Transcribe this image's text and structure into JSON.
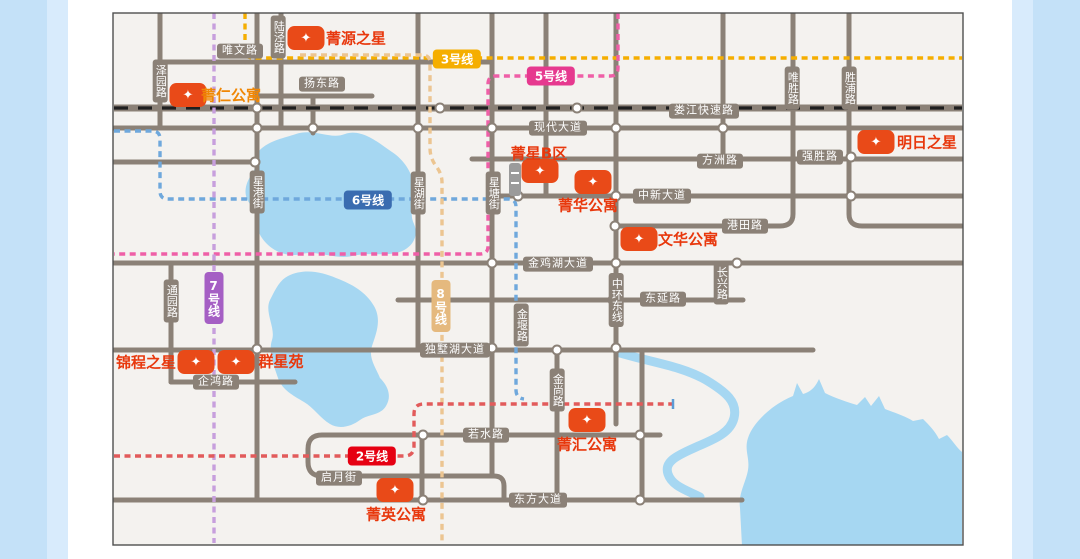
{
  "frame": {
    "outer_bg": "#ffffff",
    "left_band": {
      "x": 0,
      "w": 47,
      "color": "#c4e1f8"
    },
    "left_band_inner": {
      "x": 47,
      "w": 21,
      "color": "#d8ebfc"
    },
    "right_band_inner": {
      "x": 1012,
      "w": 21,
      "color": "#d8ebfc"
    },
    "right_band": {
      "x": 1033,
      "w": 47,
      "color": "#c4e1f8"
    }
  },
  "map": {
    "x": 113,
    "y": 13,
    "w": 850,
    "h": 532,
    "bg": "#f4f2ef",
    "border_color": "#4f4f4f"
  },
  "palette": {
    "road": "#8b8177",
    "road_badge_bg": "#8b8177",
    "badge_text": "#ffffff",
    "water": "#a6d7f2",
    "railway_dash": "#1f1f1f",
    "node_fill": "#ffffff",
    "marker_bg": "#e94a18",
    "marker_star": "#ffffff",
    "building_gray": "#9b9b9b"
  },
  "roads": [
    {
      "name": "weiwen-road",
      "d": "M160 62H492"
    },
    {
      "name": "yangdong-road",
      "d": "M258 96H372"
    },
    {
      "name": "xiandai-road",
      "d": "M114 128H962"
    },
    {
      "name": "fangzhou-qiangsheng-road",
      "d": "M472 159H962"
    },
    {
      "name": "zhongxin-road",
      "d": "M492 196H962"
    },
    {
      "name": "weisheng-gangtian-west-road",
      "d": "M793 13V214Q793 226 780 226H615"
    },
    {
      "name": "shengpu-gangtian-east-road",
      "d": "M849 13V214Q849 226 862 226H962"
    },
    {
      "name": "jinjihu-road",
      "d": "M114 263H962"
    },
    {
      "name": "dongyan-changxing-road",
      "d": "M398 300H743"
    },
    {
      "name": "dushuhu-road",
      "d": "M114 350H813"
    },
    {
      "name": "qihong-road",
      "d": "M171 382H295"
    },
    {
      "name": "ruoshui-qiyue-road",
      "d": "M660 435H322Q308 435 308 449V462Q308 476 322 476H494Q504 476 504 486V500"
    },
    {
      "name": "dongfang-road",
      "d": "M114 500H742"
    },
    {
      "name": "west-stub-road",
      "d": "M114 162H256"
    },
    {
      "name": "zeyuan-road",
      "d": "M160 13V128"
    },
    {
      "name": "xinggang-road",
      "d": "M257 13V500"
    },
    {
      "name": "lujing-road",
      "d": "M281 13V128"
    },
    {
      "name": "short-313-road",
      "d": "M313 96V133"
    },
    {
      "name": "tongyuan-road",
      "d": "M171 263V382"
    },
    {
      "name": "xinghu-road",
      "d": "M418 13V350"
    },
    {
      "name": "xingtang-road",
      "d": "M492 13V476"
    },
    {
      "name": "v546-road",
      "d": "M546 13V196"
    },
    {
      "name": "jinshang-road",
      "d": "M557 350V500"
    },
    {
      "name": "zhonghuan-road",
      "d": "M616 13V424"
    },
    {
      "name": "v642-road",
      "d": "M642 350V500"
    },
    {
      "name": "v422-road",
      "d": "M422 435V500"
    },
    {
      "name": "v723-road",
      "d": "M723 13V159"
    }
  ],
  "railway": {
    "name": "loujiang-expressway",
    "d": "M114 108H962",
    "base_w": 7,
    "dash_w": 3.2,
    "dash": "14 10"
  },
  "waters": [
    {
      "name": "jinji-lake",
      "type": "fill",
      "d": "M296 134C315 128 330 140 345 134C362 128 380 144 392 152C404 160 412 172 414 186C416 200 408 212 414 224C420 238 410 250 396 253C382 256 368 252 352 256C336 260 318 250 302 254C286 258 270 250 262 238C254 226 258 214 250 204C242 194 246 182 252 174C258 166 252 156 262 148C272 140 284 138 296 134Z"
    },
    {
      "name": "dushu-lake",
      "type": "fill",
      "d": "M288 276C304 268 322 272 336 278C352 284 366 292 374 306C382 320 376 334 372 346C368 358 376 368 380 378C388 386 392 396 386 406C380 416 368 414 360 420C352 426 340 430 330 424C320 418 314 408 304 402C294 396 282 390 278 378C274 366 268 352 272 340C276 328 264 312 270 300C276 288 280 280 288 276Z"
    },
    {
      "name": "river",
      "type": "stroke",
      "w": 9,
      "d": "M620 353C650 362 682 366 706 380C726 392 738 402 734 418C730 434 712 440 694 448C676 456 664 462 668 474C672 486 686 490 700 497"
    },
    {
      "name": "southeast-lake",
      "type": "fill",
      "d": "M742 546L740 508C738 494 746 482 748 470C750 458 744 450 748 438C752 426 762 416 772 408C780 402 788 398 793 396L797 383L803 394C810 392 815 388 819 379L825 393C835 398 847 402 857 405L865 397L871 406L879 396L885 409C895 413 905 416 913 421L923 419C929 425 935 431 939 439L947 435C953 441 957 448 962 452L962 546Z"
    }
  ],
  "nodes": [
    [
      257,
      108
    ],
    [
      440,
      108
    ],
    [
      577,
      108
    ],
    [
      257,
      128
    ],
    [
      313,
      128
    ],
    [
      418,
      128
    ],
    [
      492,
      128
    ],
    [
      546,
      128
    ],
    [
      616,
      128
    ],
    [
      723,
      128
    ],
    [
      255,
      162
    ],
    [
      851,
      157
    ],
    [
      518,
      196
    ],
    [
      616,
      196
    ],
    [
      851,
      196
    ],
    [
      615,
      226
    ],
    [
      492,
      263
    ],
    [
      616,
      263
    ],
    [
      737,
      263
    ],
    [
      613,
      300
    ],
    [
      492,
      348
    ],
    [
      557,
      350
    ],
    [
      616,
      348
    ],
    [
      257,
      349
    ],
    [
      423,
      435
    ],
    [
      640,
      435
    ],
    [
      423,
      500
    ],
    [
      640,
      500
    ]
  ],
  "metro_lines": [
    {
      "id": "line-3",
      "dash_color": "#f5ae00",
      "d": "M245 13V50Q245 58 253 58H962",
      "badge": {
        "label": "3号线",
        "x": 457,
        "y": 59,
        "bg": "#f5ae00",
        "vertical": false
      }
    },
    {
      "id": "line-5",
      "dash_color": "#ef5fa7",
      "d": "M618 13V68Q618 76 610 76H496Q488 76 488 84V246Q488 254 480 254H114",
      "badge": {
        "label": "5号线",
        "x": 551,
        "y": 76,
        "bg": "#e6398f",
        "vertical": false
      }
    },
    {
      "id": "line-6",
      "dash_color": "#6fa8dc",
      "d": "M114 131H152Q160 131 160 139V191Q160 199 168 199H508Q516 199 516 207V390Q516 398 524 399",
      "badge": {
        "label": "6号线",
        "x": 368,
        "y": 200,
        "bg": "#3a6cb0",
        "vertical": false
      }
    },
    {
      "id": "line-7",
      "dash_color": "#c79fdd",
      "d": "M214 13V543",
      "badge": {
        "label": "7号线",
        "x": 214,
        "y": 298,
        "bg": "#a55fc4",
        "vertical": true
      }
    },
    {
      "id": "line-8",
      "dash_color": "#ecc591",
      "d": "M300 55H422Q430 55 430 63V148Q430 158 436 166Q442 174 442 182V543",
      "badge": {
        "label": "8号线",
        "x": 441,
        "y": 306,
        "bg": "#e5b97e",
        "vertical": true
      }
    },
    {
      "id": "line-2",
      "dash_color": "#e25b5b",
      "d": "M114 456H404Q414 456 414 446V414Q414 404 424 404H672",
      "badge": {
        "label": "2号线",
        "x": 372,
        "y": 456,
        "bg": "#e60012",
        "vertical": false
      },
      "end_tick": {
        "x": 673,
        "y": 404,
        "color": "#5b9bd5"
      }
    }
  ],
  "road_labels": [
    {
      "text": "唯文路",
      "x": 240,
      "y": 51,
      "vertical": false
    },
    {
      "text": "扬东路",
      "x": 322,
      "y": 84,
      "vertical": false
    },
    {
      "text": "娄江快速路",
      "x": 704,
      "y": 111,
      "vertical": false
    },
    {
      "text": "现代大道",
      "x": 558,
      "y": 128,
      "vertical": false
    },
    {
      "text": "方洲路",
      "x": 720,
      "y": 161,
      "vertical": false
    },
    {
      "text": "强胜路",
      "x": 820,
      "y": 157,
      "vertical": false
    },
    {
      "text": "中新大道",
      "x": 662,
      "y": 196,
      "vertical": false
    },
    {
      "text": "港田路",
      "x": 745,
      "y": 226,
      "vertical": false
    },
    {
      "text": "金鸡湖大道",
      "x": 558,
      "y": 264,
      "vertical": false
    },
    {
      "text": "东延路",
      "x": 663,
      "y": 299,
      "vertical": false
    },
    {
      "text": "独墅湖大道",
      "x": 455,
      "y": 350,
      "vertical": false
    },
    {
      "text": "企鸿路",
      "x": 216,
      "y": 382,
      "vertical": false
    },
    {
      "text": "若水路",
      "x": 486,
      "y": 435,
      "vertical": false
    },
    {
      "text": "启月街",
      "x": 339,
      "y": 478,
      "vertical": false
    },
    {
      "text": "东方大道",
      "x": 538,
      "y": 500,
      "vertical": false
    },
    {
      "text": "泽园路",
      "x": 160,
      "y": 81,
      "vertical": true
    },
    {
      "text": "陆泾路",
      "x": 278,
      "y": 37,
      "vertical": true
    },
    {
      "text": "唯胜路",
      "x": 792,
      "y": 88,
      "vertical": true
    },
    {
      "text": "胜浦路",
      "x": 849,
      "y": 88,
      "vertical": true
    },
    {
      "text": "星港街",
      "x": 257,
      "y": 192,
      "vertical": true
    },
    {
      "text": "星湖街",
      "x": 418,
      "y": 193,
      "vertical": true
    },
    {
      "text": "星塘街",
      "x": 493,
      "y": 193,
      "vertical": true
    },
    {
      "text": "通园路",
      "x": 171,
      "y": 301,
      "vertical": true
    },
    {
      "text": "金堰路",
      "x": 521,
      "y": 325,
      "vertical": true
    },
    {
      "text": "中环东线",
      "x": 616,
      "y": 300,
      "vertical": true
    },
    {
      "text": "长兴路",
      "x": 721,
      "y": 283,
      "vertical": true
    },
    {
      "text": "金尚路",
      "x": 557,
      "y": 390,
      "vertical": true
    }
  ],
  "properties": [
    {
      "id": "jingyuan",
      "name": "菁源之星",
      "marker": {
        "x": 306,
        "y": 38
      },
      "label": {
        "x": 356,
        "y": 38,
        "color": "#e8380d"
      }
    },
    {
      "id": "jingren",
      "name": "菁仁公寓",
      "marker": {
        "x": 188,
        "y": 95
      },
      "label": {
        "x": 231,
        "y": 95,
        "color": "#f08705"
      }
    },
    {
      "id": "mingri",
      "name": "明日之星",
      "marker": {
        "x": 876,
        "y": 142
      },
      "label": {
        "x": 927,
        "y": 142,
        "color": "#e8380d"
      }
    },
    {
      "id": "jingxingbq",
      "name": "菁星B区",
      "marker": {
        "x": 540,
        "y": 171
      },
      "label": {
        "x": 539,
        "y": 153,
        "color": "#e8380d"
      }
    },
    {
      "id": "jinghua",
      "name": "菁华公寓",
      "marker": {
        "x": 593,
        "y": 182
      },
      "label": {
        "x": 588,
        "y": 205,
        "color": "#e8380d"
      }
    },
    {
      "id": "wenhua",
      "name": "文华公寓",
      "marker": {
        "x": 639,
        "y": 239
      },
      "label": {
        "x": 688,
        "y": 239,
        "color": "#e8380d"
      }
    },
    {
      "id": "jincheng",
      "name": "锦程之星",
      "marker": {
        "x": 196,
        "y": 362
      },
      "label": {
        "x": 146,
        "y": 362,
        "color": "#e8380d"
      }
    },
    {
      "id": "qunxing",
      "name": "群星苑",
      "marker": {
        "x": 236,
        "y": 362
      },
      "label": {
        "x": 281,
        "y": 361,
        "color": "#e8380d"
      }
    },
    {
      "id": "jinghui",
      "name": "菁汇公寓",
      "marker": {
        "x": 587,
        "y": 420
      },
      "label": {
        "x": 587,
        "y": 444,
        "color": "#e8380d"
      }
    },
    {
      "id": "jingying",
      "name": "菁英公寓",
      "marker": {
        "x": 395,
        "y": 490
      },
      "label": {
        "x": 396,
        "y": 514,
        "color": "#e8380d"
      }
    }
  ],
  "marker_icon": "✦",
  "building_icon": {
    "x": 509,
    "y": 163,
    "w": 12,
    "h": 33
  }
}
